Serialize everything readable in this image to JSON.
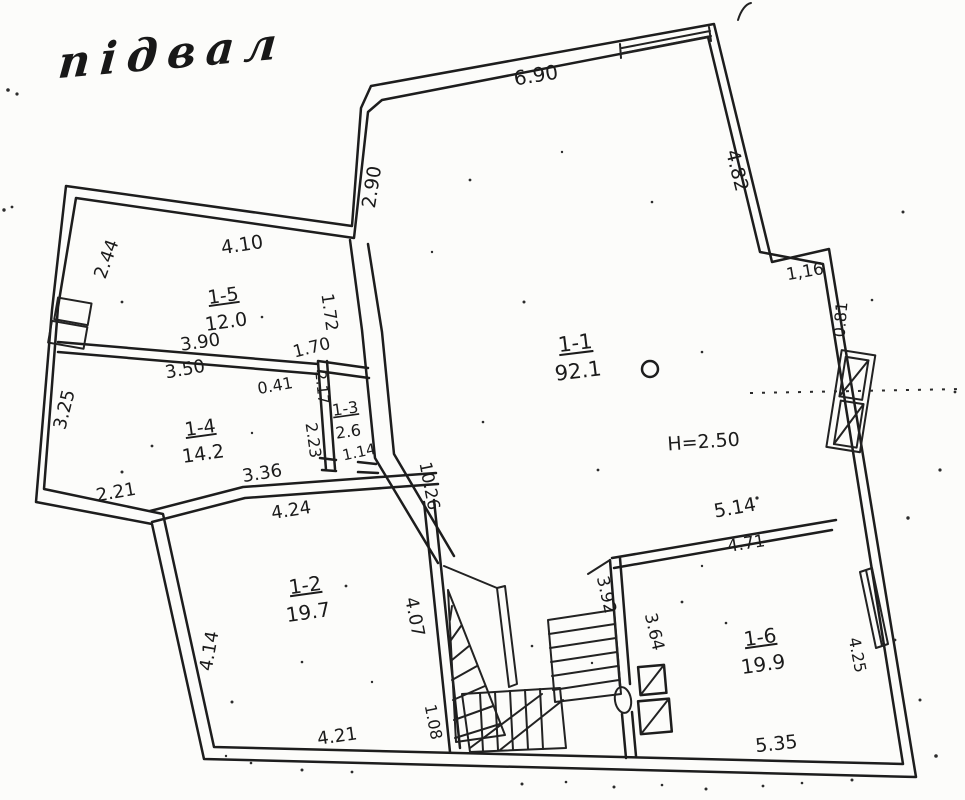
{
  "title": "підвал",
  "height_note": "Н=2.50",
  "rooms": [
    {
      "id": "1-1",
      "area": "92.1",
      "x": 576,
      "y": 350,
      "r": -7,
      "s": 21
    },
    {
      "id": "1-2",
      "area": "19.7",
      "x": 306,
      "y": 592,
      "r": -8,
      "s": 20
    },
    {
      "id": "1-3",
      "area": "2.6",
      "x": 346,
      "y": 414,
      "r": -8,
      "s": 16
    },
    {
      "id": "1-4",
      "area": "14.2",
      "x": 201,
      "y": 434,
      "r": -8,
      "s": 19
    },
    {
      "id": "1-5",
      "area": "12.0",
      "x": 224,
      "y": 302,
      "r": -8,
      "s": 19
    },
    {
      "id": "1-6",
      "area": "19.9",
      "x": 761,
      "y": 644,
      "r": -8,
      "s": 20
    }
  ],
  "dims": [
    {
      "t": "6.90",
      "x": 537,
      "y": 82,
      "r": -9,
      "s": 20
    },
    {
      "t": "2.90",
      "x": 378,
      "y": 188,
      "r": -81,
      "s": 19
    },
    {
      "t": "4.82",
      "x": 731,
      "y": 172,
      "r": 76,
      "s": 19
    },
    {
      "t": "1,16",
      "x": 806,
      "y": 277,
      "r": -10,
      "s": 17
    },
    {
      "t": "0.81",
      "x": 846,
      "y": 320,
      "r": -85,
      "s": 16
    },
    {
      "t": "4.10",
      "x": 243,
      "y": 251,
      "r": -9,
      "s": 19
    },
    {
      "t": "2.44",
      "x": 112,
      "y": 261,
      "r": -70,
      "s": 18
    },
    {
      "t": "1.72",
      "x": 324,
      "y": 313,
      "r": 82,
      "s": 17
    },
    {
      "t": "3.90",
      "x": 201,
      "y": 348,
      "r": -8,
      "s": 18
    },
    {
      "t": "3.50",
      "x": 186,
      "y": 375,
      "r": -10,
      "s": 18
    },
    {
      "t": "1.70",
      "x": 313,
      "y": 353,
      "r": -14,
      "s": 17
    },
    {
      "t": "0.41",
      "x": 276,
      "y": 391,
      "r": -10,
      "s": 16
    },
    {
      "t": "2.17",
      "x": 317,
      "y": 388,
      "r": 84,
      "s": 15
    },
    {
      "t": "2.23",
      "x": 308,
      "y": 441,
      "r": 82,
      "s": 16
    },
    {
      "t": "1.14",
      "x": 360,
      "y": 457,
      "r": -12,
      "s": 15
    },
    {
      "t": "3.25",
      "x": 70,
      "y": 411,
      "r": -76,
      "s": 18
    },
    {
      "t": "2.21",
      "x": 117,
      "y": 498,
      "r": -10,
      "s": 18
    },
    {
      "t": "3.36",
      "x": 263,
      "y": 479,
      "r": -9,
      "s": 18
    },
    {
      "t": "4.24",
      "x": 292,
      "y": 516,
      "r": -9,
      "s": 18
    },
    {
      "t": "10.26",
      "x": 424,
      "y": 487,
      "r": 79,
      "s": 17
    },
    {
      "t": "4.14",
      "x": 215,
      "y": 652,
      "r": -80,
      "s": 18
    },
    {
      "t": "4.07",
      "x": 409,
      "y": 618,
      "r": 79,
      "s": 18
    },
    {
      "t": "1.08",
      "x": 428,
      "y": 723,
      "r": 79,
      "s": 16
    },
    {
      "t": "4.21",
      "x": 338,
      "y": 742,
      "r": -8,
      "s": 18
    },
    {
      "t": "3.92",
      "x": 601,
      "y": 596,
      "r": 77,
      "s": 17
    },
    {
      "t": "3.64",
      "x": 649,
      "y": 633,
      "r": 77,
      "s": 17
    },
    {
      "t": "5.14",
      "x": 736,
      "y": 514,
      "r": -10,
      "s": 19
    },
    {
      "t": "4.71",
      "x": 747,
      "y": 549,
      "r": -9,
      "s": 17
    },
    {
      "t": "5.35",
      "x": 777,
      "y": 750,
      "r": -6,
      "s": 19
    },
    {
      "t": "4.25",
      "x": 852,
      "y": 656,
      "r": 79,
      "s": 16
    },
    {
      "t": "Н=2.50",
      "x": 704,
      "y": 448,
      "r": -4,
      "s": 19,
      "n": "height-note"
    }
  ]
}
